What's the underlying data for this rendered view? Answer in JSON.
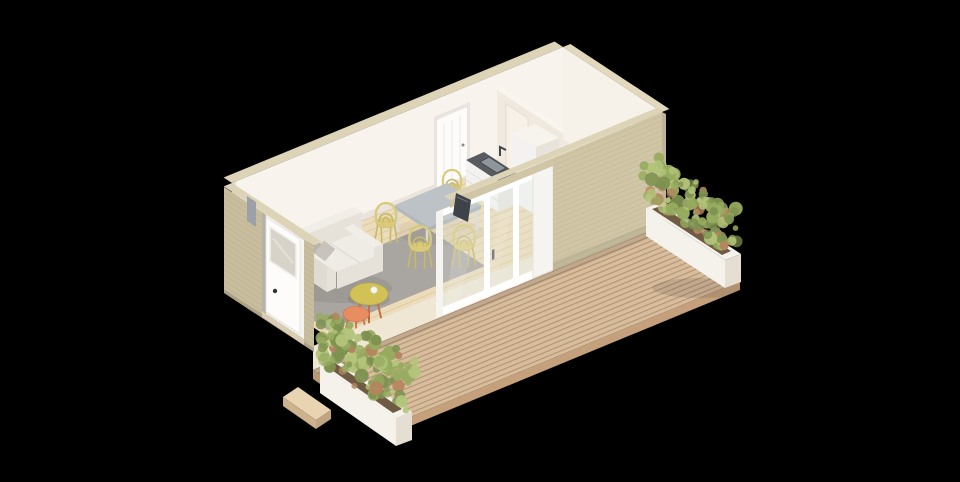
{
  "scene": {
    "title": "Isometric 3D render — studio cabin floor plan with timber deck",
    "background": "#000000",
    "rooms": [
      {
        "name": "living-dining-kitchenette"
      },
      {
        "name": "empty-second-room"
      }
    ],
    "objects": {
      "entry_door": "white entry door, ajar, glazed upper panel, dark handle",
      "interior_door": "white interior door in back wall",
      "partition_doorway": "open doorway in partition wall near back wall",
      "sliding_door": "three-panel sliding glass door, white frame",
      "tv": "dark wall-mounted TV beside sliding door",
      "kitchen": [
        "dark sink counter with drawers and faucet",
        "tall white cabinet"
      ],
      "dining": [
        "grey dining table",
        "four yellow wire chairs"
      ],
      "living": [
        "white two-seat sofa",
        "two grey cushions",
        "round yellow coffee table",
        "orange side table",
        "white cup",
        "grey area rug"
      ],
      "outdoor": [
        "diagonal timber deck",
        "white planter box right",
        "white planter box front",
        "timber entry step"
      ]
    },
    "palette": {
      "background": "#000000",
      "wall_exterior": "#d0c6a6",
      "wall_exterior_dark": "#c8bd9d",
      "wall_band": "#ddd3b6",
      "wall_interior": "#f8f3ec",
      "wall_interior_shade": "#f0e9df",
      "floor_wood": "#ecdcba",
      "floor_bedroom": "#f3ecdf",
      "floor_edge": "#efe6d4",
      "rug": "#a9a5a1",
      "deck": "#d8bd9d",
      "deck_fascia": "#c4a17c",
      "sofa": "#f1eee8",
      "sofa_shade": "#e6e1d9",
      "sofa_dark": "#e0dbd2",
      "pillow_a": "#b9b4ad",
      "pillow_b": "#c8c3bc",
      "coffee_table": "#d2c154",
      "side_table": "#e88d60",
      "leg_orange": "#c2714e",
      "chair": "#d9ca79",
      "chair_dark": "#c8b869",
      "dining_table": "#bdc2c6",
      "dining_table_edge": "#aeb3b7",
      "counter_top": "#585c60",
      "sink": "#8e959b",
      "cabinet": "#f3f2f0",
      "cabinet_shade": "#e8e5e0",
      "fridge_top": "#f7f4ee",
      "fridge_side": "#e9e4db",
      "planter": "#f5f2ec",
      "planter_shade": "#e4ded3",
      "foliage_dark": "#7e9150",
      "foliage_mid": "#96ab5f",
      "foliage_light": "#b3c47a",
      "foliage_rust": "#b5845e",
      "door_white": "#fdfcfa",
      "frame_white": "#f6f4f0",
      "glass": "#e1ebea",
      "tv": "#3e434a",
      "step": "#e9d4b2"
    }
  }
}
